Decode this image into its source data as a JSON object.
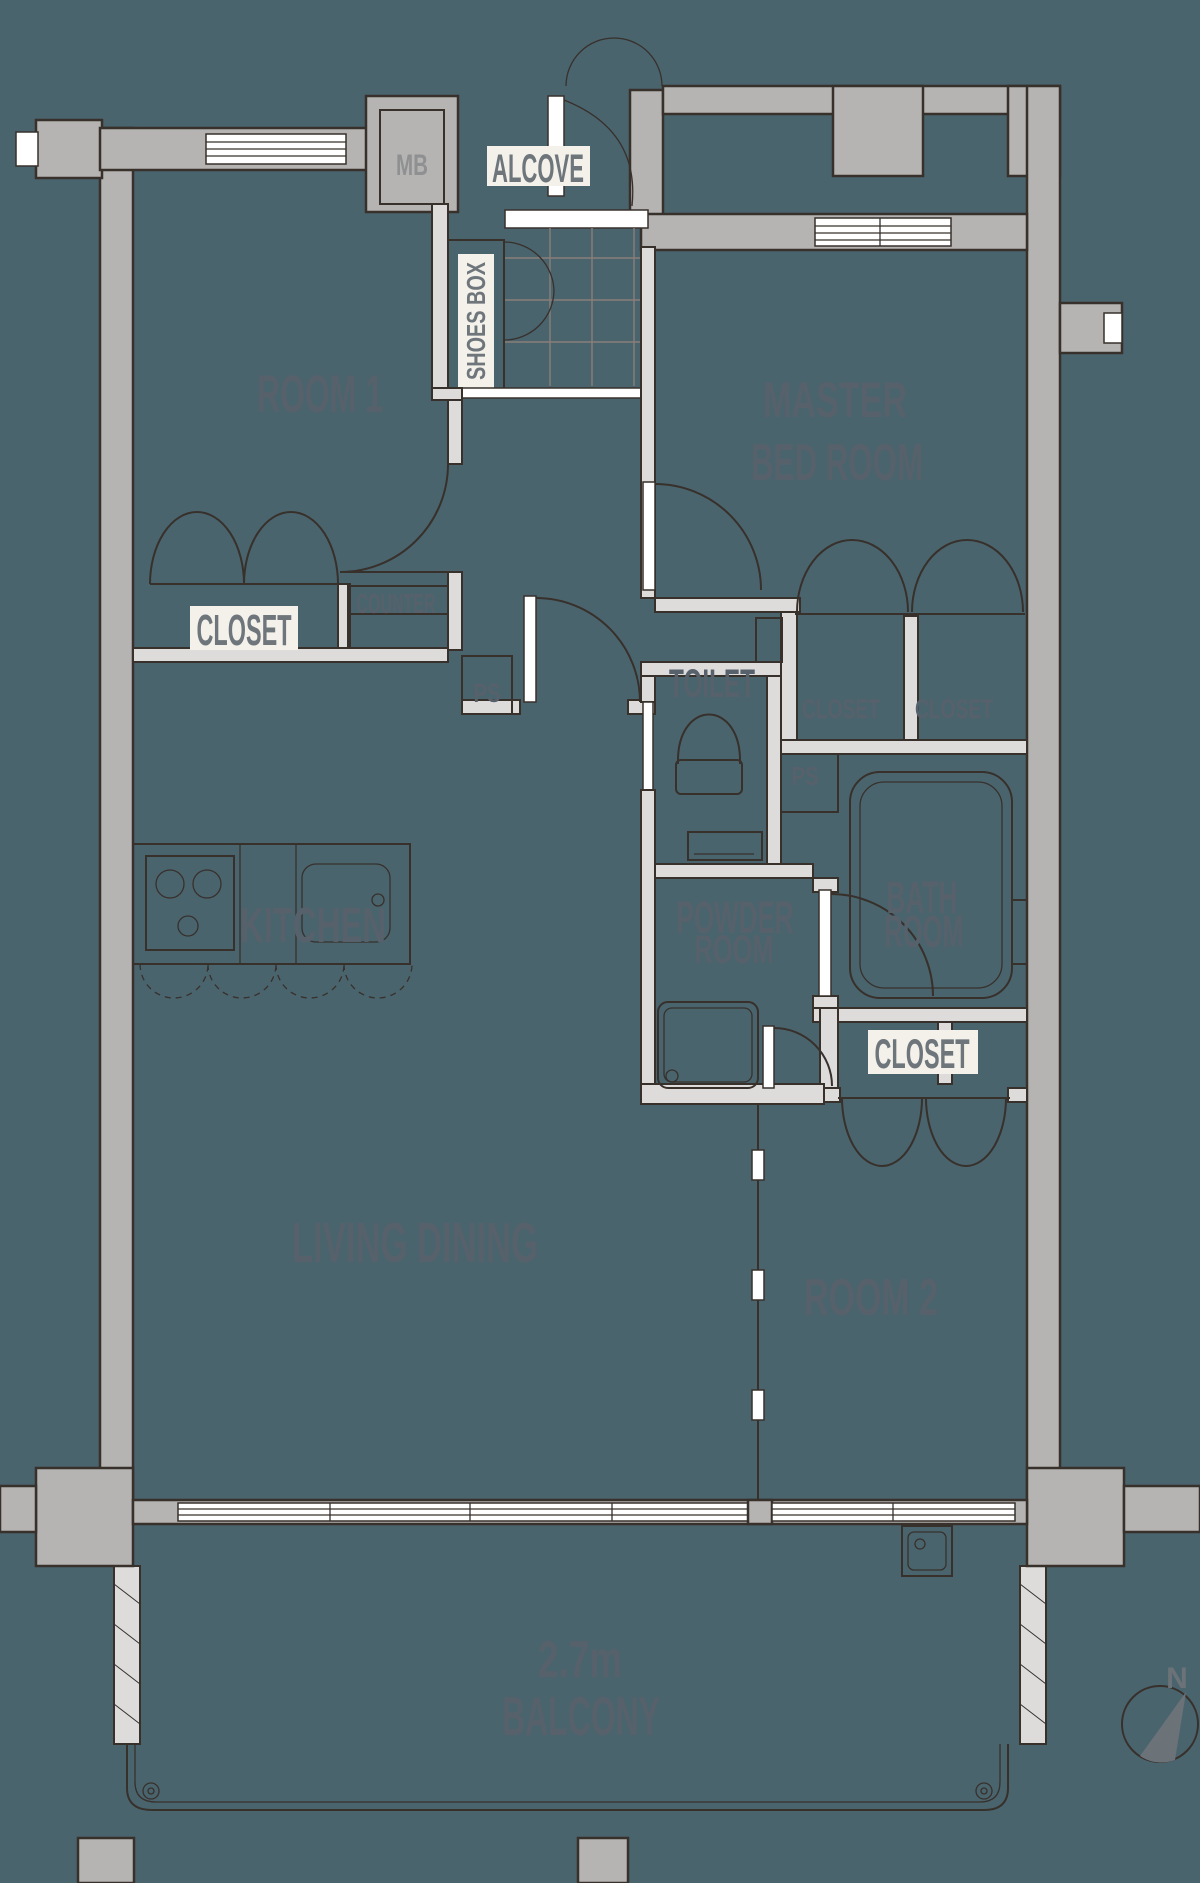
{
  "colors": {
    "bg": "#4A646E",
    "wall": "#B5B4B3",
    "iwall": "#DDDCDB",
    "line": "#37302B",
    "grid": "#8A7E78",
    "floorLabel": "#56616B",
    "whiteTag": "#F3F1EA",
    "whiteTagText": "#6E767C",
    "mbText": "#8F9092",
    "compass": "#6B7278"
  },
  "labels": {
    "mb": "MB",
    "alcove": "ALCOVE",
    "shoes_box": "SHOES BOX",
    "room1": "ROOM 1",
    "master_line1": "MASTER",
    "master_line2": "BED ROOM",
    "closet_room1": "CLOSET",
    "counter": "COUNTER",
    "ps_left": "PS",
    "kitchen": "KITCHEN",
    "toilet": "TOILET",
    "closet_master_left": "CLOSET",
    "closet_master_right": "CLOSET",
    "ps_right": "PS",
    "bath_line1": "BATH",
    "bath_line2": "ROOM",
    "powder_line1": "POWDER",
    "powder_line2": "ROOM",
    "closet_room2": "CLOSET",
    "living_dining": "LIVING DINING",
    "room2": "ROOM 2",
    "balcony_size": "2.7m",
    "balcony": "BALCONY",
    "compass_north": "N"
  }
}
